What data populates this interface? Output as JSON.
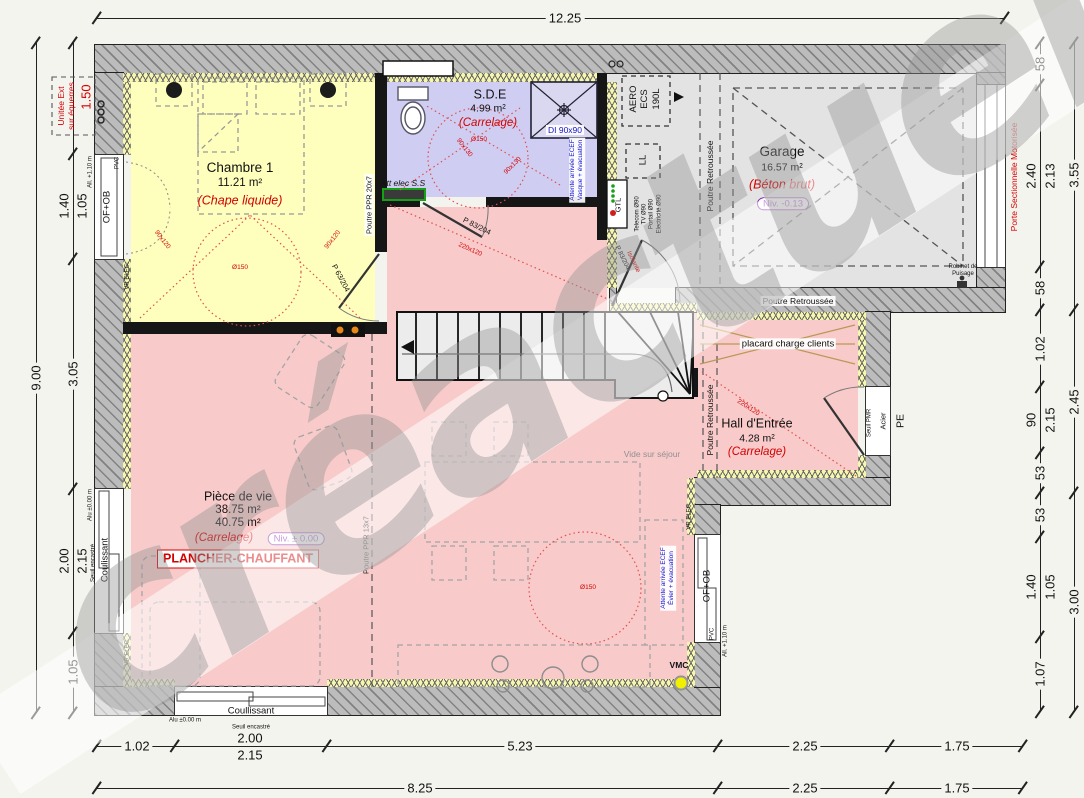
{
  "watermark": "créactuel",
  "colors": {
    "red": "#d40000",
    "blue": "#1414cc",
    "purple": "#8820b0",
    "bg": "#f4f4ef",
    "chambre": "#ffffbd",
    "sde": "#cfcef2",
    "garage": "#e3e3e3",
    "living": "#f8caca",
    "wall": "#bcbcbc",
    "insulation": "#f6f6ae"
  },
  "rooms": {
    "chambre": {
      "name": "Chambre 1",
      "area": "11.21 m²",
      "floor": "(Chape liquide)"
    },
    "sde": {
      "name": "S.D.E",
      "area": "4.99 m²",
      "floor": "(Carrelage)",
      "shower": "DI 90x90"
    },
    "garage": {
      "name": "Garage",
      "area": "16.57 m²",
      "floor": "(Béton brut)",
      "level": "Niv. -0.13"
    },
    "piece_de_vie": {
      "name": "Pièce de vie",
      "area1": "38.75 m²",
      "area2": "40.75 m²",
      "floor": "(Carrelage)",
      "level": "Niv. ± 0.00",
      "heating": "PLANCHER-CHAUFFANT"
    },
    "hall": {
      "name": "Hall d'Entrée",
      "area": "4.28 m²",
      "floor": "(Carrelage)"
    }
  },
  "annotations": {
    "placard": "placard charge clients",
    "vide_sejour": "Vide sur séjour",
    "poutre_retroussee": "Poutre Retroussée",
    "poutre_ppr20": "Poutre PPR 20x7",
    "poutre_ppr13": "Poutre PPR 13x7",
    "att_elec": "Att elec S.S",
    "attente_ecef": "Attente arrivée ECEF",
    "vasque": "Vasque + évacuation",
    "evier": "Évier + évacuation",
    "aero1": "AERO",
    "aero2": "ECS",
    "aero3": "190L",
    "ll": "LL",
    "gtl": "GTL",
    "telecom": "Telecom Ø90",
    "tv": "TV Ø90",
    "portail": "Portail Ø90",
    "electricite": "Electricité Ø90",
    "vmc": "VMC",
    "robinet1": "Robinet de",
    "robinet2": "Puisage",
    "unite1": "Unitée Ext",
    "unite2": "sur équerres",
    "diam150": "Ø150",
    "clr_chambre": "90x120",
    "clr_sde": "90x130",
    "clr_living": "220x120"
  },
  "openings": {
    "p63": "P 63/204",
    "p83": "P 83/204",
    "p83_iso": "Isolante",
    "porte_sectionnelle": "Porte Sectionnelle Motorisée",
    "pe": "PE",
    "acier": "Acier",
    "seuil_pmr": "Seuil PMR",
    "of_ob": "OF+OB",
    "pvc": "PVC",
    "coulissant": "Coulissant",
    "coullissant": "Coullissant",
    "seuil_encastre": "Seuil encastré",
    "alu": "Alu ±0.00 m",
    "allege": "All. +1.10 m",
    "vr_elec": "VR ELEC."
  },
  "dimensions": {
    "top": "12.25",
    "left_total": "9.00",
    "l150": "1.50",
    "l140": "1.40",
    "l105a": "1.05",
    "l305": "3.05",
    "l200": "2.00",
    "l215": "2.15",
    "l105b": "1.05",
    "r58a": "58",
    "r240": "2.40",
    "r213": "2.13",
    "r58b": "58",
    "r355": "3.55",
    "r102": "1.02",
    "r90": "90",
    "r215": "2.15",
    "r53a": "53",
    "r53b": "53",
    "r140": "1.40",
    "r105": "1.05",
    "r107": "1.07",
    "r245": "2.45",
    "r300": "3.00",
    "b102": "1.02",
    "b200": "2.00",
    "b215": "2.15",
    "b523": "5.23",
    "b225a": "2.25",
    "b175a": "1.75",
    "b825": "8.25",
    "b225b": "2.25",
    "b175b": "1.75"
  }
}
